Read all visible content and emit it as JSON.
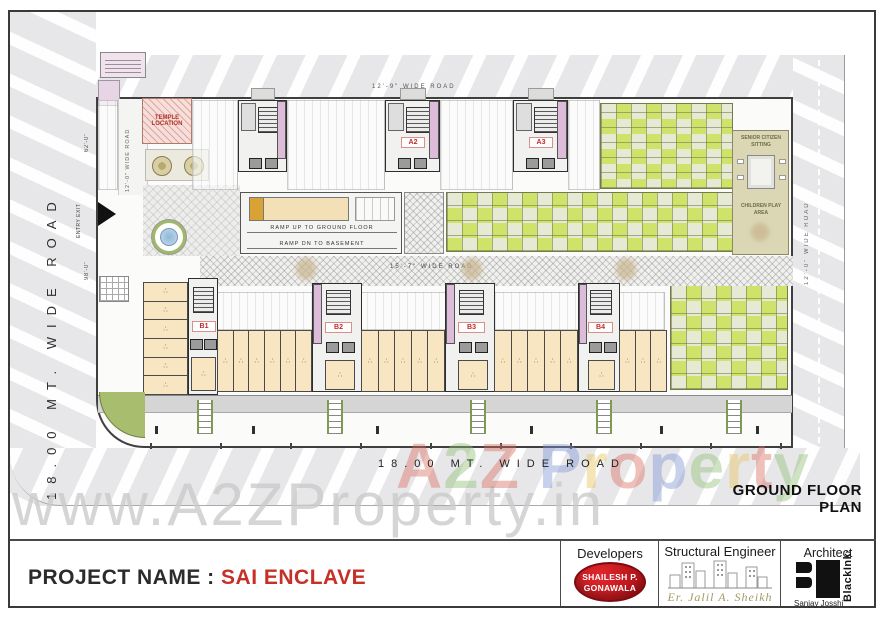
{
  "roads": {
    "left": "18.00 MT. WIDE ROAD",
    "bottom": "18.00 MT. WIDE ROAD",
    "top": "12'-9\" WIDE ROAD",
    "inner_left": "12'-0\" WIDE ROAD",
    "right": "12'-0\" WIDE ROAD",
    "middle": "15'-7\" WIDE ROAD"
  },
  "site": {
    "temple_line1": "TEMPLE",
    "temple_line2": "LOCATION",
    "ramp_up": "RAMP UP TO GROUND FLOOR",
    "ramp_dn": "RAMP DN TO BASEMENT",
    "senior_sitting": "SENIOR CITIZEN SITTING",
    "children_play": "CHILDREN PLAY AREA",
    "entry_exit": "ENTRY EXIT",
    "dim_top": "62'-0\"",
    "dim_bottom": "98'-0\"",
    "buildings": {
      "a2": "A2",
      "a3": "A3",
      "b1": "B1",
      "b2": "B2",
      "b3": "B3",
      "b4": "B4"
    },
    "shops": {
      "left_col": 6,
      "row1": 6,
      "row2": 5,
      "row3": 5,
      "row4": 3
    },
    "shop_icon_glyph": "∴"
  },
  "plan_title": "GROUND FLOOR PLAN",
  "watermark": {
    "gray": "www.A2ZProperty.in",
    "letters": [
      {
        "ch": "A",
        "color": "#db6a5f"
      },
      {
        "ch": "2",
        "color": "#8bbf72"
      },
      {
        "ch": "Z",
        "color": "#db6a5f"
      },
      {
        "ch": " ",
        "color": "#000000"
      },
      {
        "ch": "P",
        "color": "#7d95d4"
      },
      {
        "ch": "r",
        "color": "#e7c254"
      },
      {
        "ch": "o",
        "color": "#db6a5f"
      },
      {
        "ch": "p",
        "color": "#7d95d4"
      },
      {
        "ch": "e",
        "color": "#8bbf72"
      },
      {
        "ch": "r",
        "color": "#e7c254"
      },
      {
        "ch": "t",
        "color": "#db6a5f"
      },
      {
        "ch": "y",
        "color": "#8bbf72"
      }
    ]
  },
  "footer": {
    "project_label": "PROJECT NAME :",
    "project_name": "SAI ENCLAVE",
    "developers_heading": "Developers",
    "developer_line1": "SHAILESH P.",
    "developer_line2": "GONAWALA",
    "structural_heading": "Structural Engineer",
    "structural_name": "Er. Jalil A. Sheikh",
    "architect_heading": "Architect",
    "architect_brand": "BlackInk",
    "architect_tm": "™",
    "architect_name": "Sanjay Josshi"
  },
  "colors": {
    "garden_green": "#cfe36b",
    "shop_beige": "#f7e6c1",
    "lift_pink": "#dcbcd8",
    "temple_pink": "#f6dedb",
    "label_red": "#c1292b",
    "project_red": "#c53027",
    "oval_red": "#c6171e",
    "engineer_olive": "#a39a67",
    "corner_green": "#a9bd6e"
  }
}
